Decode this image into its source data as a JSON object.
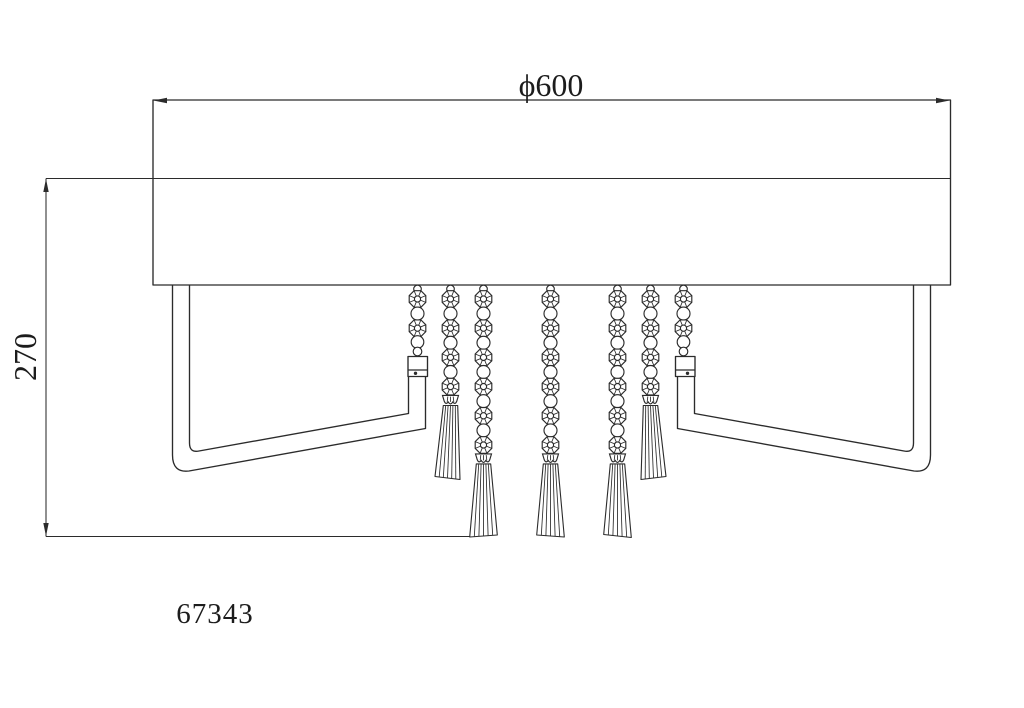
{
  "labels": {
    "diameter": "ϕ600",
    "height": "270",
    "model": "67343"
  },
  "colors": {
    "line": "#2b2b2b",
    "text": "#1c1c1c",
    "background": "#ffffff"
  },
  "diagram": {
    "object": "crystal-ceiling-lamp-side-elevation",
    "canvas": {
      "width": 1024,
      "height": 708
    },
    "chain": {
      "top_link_y": 289,
      "top_link_r": 3.8,
      "first_octagon_y": 299,
      "octagon_spacing": 29.2,
      "octagon_r": 9,
      "circle_r": 6.5
    },
    "types": {
      "connector": {
        "octagons": 2,
        "tail": [
          {
            "y": 342,
            "r": 6.3
          },
          {
            "y": 351.5,
            "r": 4.3
          }
        ]
      },
      "medium": {
        "octagons": 4,
        "cap_y": 395.4,
        "fan_top": 405.5,
        "fan_bottom": 478,
        "fan_hw_top": 7.2,
        "fan_hw_bottom": 12.5
      },
      "long": {
        "octagons": 6,
        "cap_y": 453.9,
        "fan_top": 463.9,
        "fan_bottom": 536,
        "fan_hw_top": 7.2,
        "fan_hw_bottom": 13.8
      }
    },
    "strands": [
      {
        "x": 417.5,
        "type": "connector",
        "name": "bead-chain-left-arm",
        "shift": 0,
        "tilt": 0
      },
      {
        "x": 450.5,
        "type": "medium",
        "name": "bead-chain-tassel-1",
        "shift": -3,
        "tilt": 3
      },
      {
        "x": 483.5,
        "type": "long",
        "name": "bead-chain-tassel-2",
        "shift": 0,
        "tilt": -2
      },
      {
        "x": 550.5,
        "type": "long",
        "name": "bead-chain-tassel-3",
        "shift": 0,
        "tilt": 2
      },
      {
        "x": 617.5,
        "type": "long",
        "name": "bead-chain-tassel-4",
        "shift": 0,
        "tilt": 3
      },
      {
        "x": 650.5,
        "type": "medium",
        "name": "bead-chain-tassel-5",
        "shift": 3,
        "tilt": -3
      },
      {
        "x": 683.5,
        "type": "connector",
        "name": "bead-chain-right-arm",
        "shift": 0,
        "tilt": 0
      }
    ]
  },
  "paths": {
    "body_outline": "M153,100 H950.5 V285 H153 Z",
    "body_mid_line": "M46,178.5 H950.5",
    "dim_height_line": "M46,178.5 V536.5",
    "dim_height_ext": "M46,536.5 H470",
    "arrow_dia_left": "M153.5,100.5 L167,97.7 L167,103.3 Z",
    "arrow_dia_right": "M949.5,100.5 L936,97.7 L936,103.3 Z",
    "arrow_height_top": "M46,178.8 L43.3,192 L48.7,192 Z",
    "arrow_height_bottom": "M46,536.2 L43.3,523 L48.7,523 Z",
    "left_frame_outer": "M172.5,285 V455 Q172.5,473 189,471 L425.5,428.5 V376.5",
    "left_frame_inner": "M189.5,285 V443 Q189.5,453 199,451 L408.5,413.5 V376.5",
    "right_frame_outer": "M930.5,285 V455 Q930.5,473 914,471 L677.5,428.5 V376.5",
    "right_frame_inner": "M913.5,285 V443 Q913.5,453 904,451 L694.5,413.5 V376.5",
    "left_socket": "M408,356.5 H427.5 V376.5 H408 Z M408,370 H427.5",
    "right_socket": "M675.5,356.5 H695 V376.5 H675.5 Z M675.5,370 H695"
  },
  "socket_pins": [
    {
      "x": 415.5,
      "y": 373.3
    },
    {
      "x": 687.5,
      "y": 373.3
    }
  ]
}
